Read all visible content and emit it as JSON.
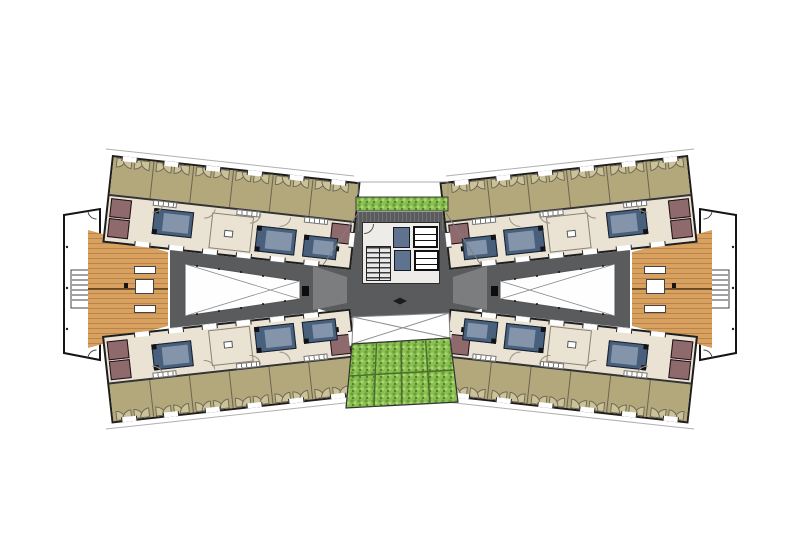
{
  "document": {
    "kind": "architectural-floor-plan",
    "description": "Butterfly-shaped building floor plan: two angled room wings with courtyard voids, timber decks and terrace outlines at the ends, central elevator and stair core, hedge strip above and green roof panels below the core",
    "visible_text": []
  },
  "colors": {
    "bg": "#ffffff",
    "wall": "#1e1e1e",
    "khaki": "#b3a87c",
    "khaki_leaf": "#ccc29a",
    "cream": "#eae2d3",
    "mauve": "#8e6a6d",
    "bed_dark": "#49607c",
    "bed_light": "#8495ab",
    "wood": "#d8a160",
    "floor": "#595b5c",
    "floor_light": "#7e8183",
    "lift": "#5f7391",
    "g_base": "#8abf52",
    "g_dark": "#679f38",
    "g_light": "#abd76f",
    "g_deep": "#55832c"
  },
  "elements": {
    "wings": [
      {
        "side": "left",
        "room_bars": 2,
        "khaki_rooms_per_bar": 6,
        "beds_visible_per_bar": 3,
        "wardrobe_blocks_per_bar": 3,
        "deck": "timber",
        "terrace_outline": true,
        "terrace_stair": true,
        "courtyard_void_open_to_below": true
      },
      {
        "side": "right",
        "room_bars": 2,
        "khaki_rooms_per_bar": 6,
        "beds_visible_per_bar": 3,
        "wardrobe_blocks_per_bar": 3,
        "deck": "timber",
        "terrace_outline": true,
        "terrace_stair": true,
        "courtyard_void_open_to_below": true
      }
    ],
    "center": {
      "hedge_strip_top": true,
      "green_roof_panel_rows": 2,
      "green_roof_panel_cols": 4,
      "elevator_shafts": 2,
      "elevator_cars": 2,
      "stair_flight": 1,
      "void_open_to_below": true
    }
  }
}
